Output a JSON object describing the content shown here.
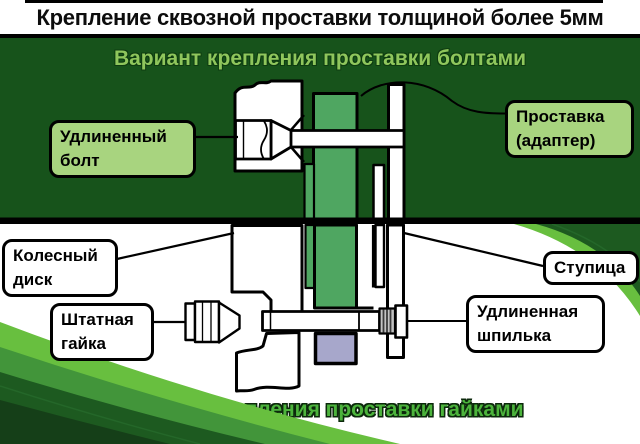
{
  "title": "Крепление сквозной проставки толщиной более 5мм",
  "sections": {
    "bolts_heading": "Вариант крепления проставки болтами",
    "nuts_heading": "Вариант крепления проставки гайками"
  },
  "labels": {
    "extended_bolt": "Удлиненный болт",
    "spacer_adapter": "Проставка (адаптер)",
    "wheel_disc": "Колесный диск",
    "hub": "Ступица",
    "stock_nut": "Штатная гайка",
    "extended_stud": "Удлиненная шпилька"
  },
  "colors": {
    "dark-green": "#17531b",
    "subtitle-green": "#8fc65c",
    "label-green": "#a8d47f",
    "spacer-green": "#4fa661",
    "lavender": "#a7a7cb",
    "swoosh-bright": "#68bf3f",
    "swoosh-mid": "#42953a",
    "swoosh-dark": "#1d5a20",
    "swoosh-darkest": "#153f18",
    "bottom-heading-green": "#4cb43c"
  }
}
